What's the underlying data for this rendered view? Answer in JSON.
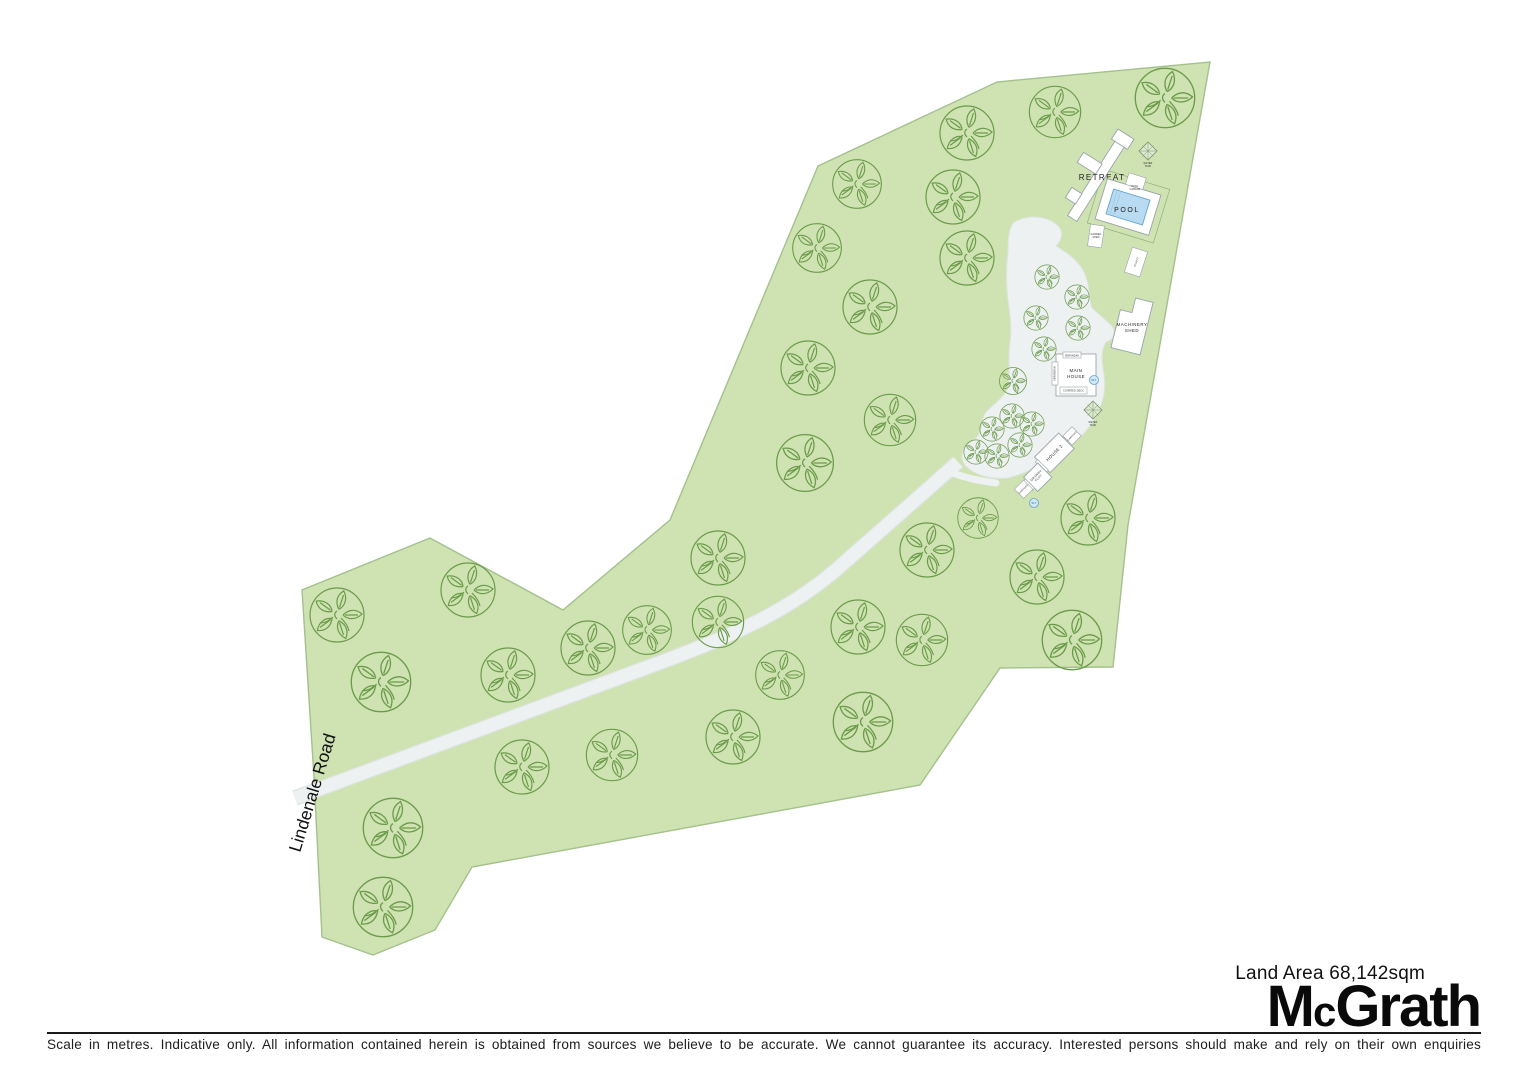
{
  "road": {
    "label": "Lindenale Road"
  },
  "site": {
    "retreat": "RETREAT",
    "pool": "POOL",
    "pool_cabana_line1": "POOL",
    "pool_cabana_line2": "CABANA",
    "garden_shed_line1": "GARDEN",
    "garden_shed_line2": "SHED",
    "studio": "STUDIO",
    "machinery_shed_line1": "MACHINERY",
    "machinery_shed_line2": "SHED",
    "main_house_line1": "MAIN",
    "main_house_line2": "HOUSE",
    "verandah_top": "VERANDAH",
    "verandah_left": "VERANDAH",
    "covered_deck": "COVERED DECK",
    "house2": "HOUSE 2",
    "granny_flat_line1": "GRANNY",
    "granny_flat_line2": "FLAT",
    "carport": "CARPORT",
    "water_tank_abbr": "W.T.",
    "marker_line1": "WATER",
    "marker_line2": "TANK"
  },
  "footer": {
    "land_area": "Land Area 68,142sqm",
    "brand_m": "M",
    "brand_c": "c",
    "brand_rest": "Grath",
    "disclaimer": "Scale in metres. Indicative only. All information contained herein is obtained from sources we believe to be accurate. We cannot guarantee its accuracy. Interested persons should make and rely on their own enquiries"
  },
  "colors": {
    "land_green": "#cfe3b2",
    "tree_green": "#6b9a4a",
    "clearing_grey": "#edf1f2",
    "pool_blue": "#b9dbf1",
    "brand_black": "#0a0a0a"
  },
  "trees": {
    "large": [
      [
        967,
        133,
        1.0
      ],
      [
        1055,
        112,
        0.95
      ],
      [
        1165,
        98,
        1.1
      ],
      [
        857,
        184,
        0.9
      ],
      [
        953,
        197,
        1.0
      ],
      [
        817,
        248,
        0.9
      ],
      [
        967,
        258,
        1.0
      ],
      [
        870,
        307,
        1.0
      ],
      [
        808,
        368,
        1.0
      ],
      [
        890,
        420,
        0.95
      ],
      [
        805,
        463,
        1.05
      ],
      [
        978,
        518,
        0.75
      ],
      [
        927,
        550,
        1.0
      ],
      [
        1088,
        518,
        1.0
      ],
      [
        1037,
        577,
        1.0
      ],
      [
        858,
        627,
        1.0
      ],
      [
        922,
        640,
        0.95
      ],
      [
        1072,
        640,
        1.1
      ],
      [
        863,
        722,
        1.1
      ],
      [
        780,
        675,
        0.9
      ],
      [
        718,
        558,
        1.0
      ],
      [
        718,
        622,
        0.95
      ],
      [
        733,
        737,
        1.0
      ],
      [
        337,
        615,
        1.0
      ],
      [
        468,
        590,
        1.0
      ],
      [
        381,
        682,
        1.1
      ],
      [
        508,
        675,
        1.0
      ],
      [
        588,
        648,
        1.0
      ],
      [
        647,
        630,
        0.9
      ],
      [
        393,
        828,
        1.1
      ],
      [
        383,
        907,
        1.1
      ],
      [
        522,
        767,
        1.0
      ],
      [
        612,
        755,
        0.95
      ]
    ],
    "small": [
      [
        1047,
        277
      ],
      [
        1077,
        297
      ],
      [
        1036,
        318
      ],
      [
        1078,
        328
      ],
      [
        1044,
        349
      ],
      [
        1012,
        416
      ],
      [
        992,
        429
      ],
      [
        1020,
        445
      ],
      [
        997,
        456
      ],
      [
        976,
        452
      ],
      [
        1032,
        424
      ]
    ],
    "dark": [
      [
        1013,
        381
      ]
    ]
  }
}
